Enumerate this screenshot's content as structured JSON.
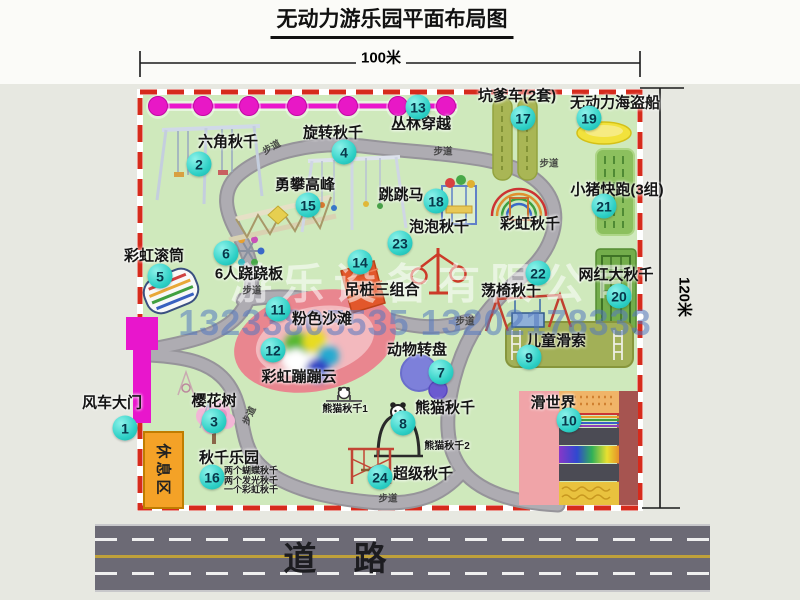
{
  "title": "无动力游乐园平面布局图",
  "dimensions": {
    "top": "100米",
    "right": "120米"
  },
  "road": {
    "label": "道 路"
  },
  "rest_area_label": "休息区",
  "footpath_label": "步道",
  "watermark": {
    "company": "游乐设备有限公司",
    "phone": "13233805535 13202178333"
  },
  "extra_labels": {
    "rainbow_swing": "彩虹秋千",
    "panda_swing_1": "熊猫秋千1",
    "panda_swing_2": "熊猫秋千2"
  },
  "attractions": [
    {
      "num": "1",
      "label": "风车大门"
    },
    {
      "num": "2",
      "label": "六角秋千"
    },
    {
      "num": "3",
      "label": "樱花树"
    },
    {
      "num": "4",
      "label": "旋转秋千"
    },
    {
      "num": "5",
      "label": "彩虹滚筒"
    },
    {
      "num": "6",
      "label": "6人跷跷板"
    },
    {
      "num": "7",
      "label": "动物转盘"
    },
    {
      "num": "8",
      "label": "熊猫秋千"
    },
    {
      "num": "9",
      "label": "儿童滑索"
    },
    {
      "num": "10",
      "label": "滑世界"
    },
    {
      "num": "11",
      "label": "粉色沙滩"
    },
    {
      "num": "12",
      "label": "彩虹蹦蹦云"
    },
    {
      "num": "13",
      "label": "丛林穿越"
    },
    {
      "num": "14",
      "label": "吊桩三组合"
    },
    {
      "num": "15",
      "label": "勇攀高峰"
    },
    {
      "num": "16",
      "label": "秋千乐园",
      "notes": [
        "两个蝴蝶秋千",
        "两个发光秋千",
        "一个彩虹秋千"
      ]
    },
    {
      "num": "17",
      "label": "坑爹车(2套)"
    },
    {
      "num": "18",
      "label": "跳跳马"
    },
    {
      "num": "19",
      "label": "无动力海盗船"
    },
    {
      "num": "20",
      "label": "网红大秋千"
    },
    {
      "num": "21",
      "label": "小猪快跑(3组)"
    },
    {
      "num": "22",
      "label": "荡椅秋千"
    },
    {
      "num": "23",
      "label": "泡泡秋千"
    },
    {
      "num": "24",
      "label": "超级秋千"
    }
  ],
  "colors": {
    "park_green": "#cfe9bc",
    "border_red": "#d62b1c",
    "badge_cyan": "#2ed0c6",
    "zipline_magenta": "#ea16cc",
    "road_gray": "#6c6a75",
    "rest_area_orange": "#f4a227"
  }
}
